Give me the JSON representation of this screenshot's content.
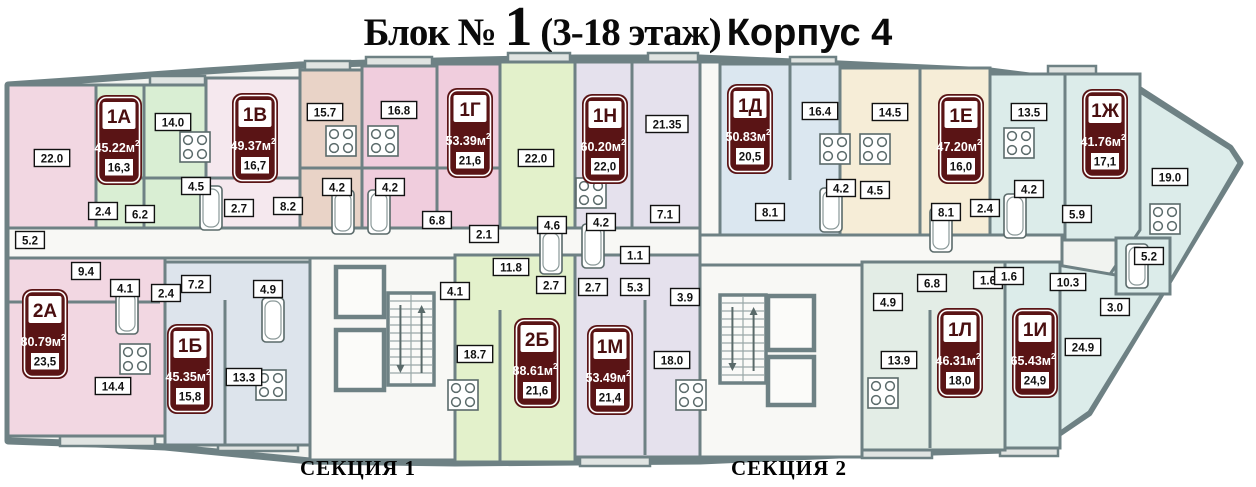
{
  "title": {
    "block": "Блок № ",
    "floor_number": "1",
    "floors": " (3-18 этаж)",
    "building": "Корпус 4"
  },
  "section_labels": [
    {
      "text": "СЕКЦИЯ 1",
      "x": 300,
      "y": 456
    },
    {
      "text": "СЕКЦИЯ 2",
      "x": 731,
      "y": 456
    }
  ],
  "palette": {
    "wall": "#6e8184",
    "outlinefill": "#f1f3f0",
    "badge": "#5a1415",
    "badgetext": "#4a0f10",
    "pink": "#f2d7e2",
    "palepink": "#f5e8ee",
    "tan": "#e9d3c7",
    "rose": "#f0cddd",
    "mint": "#d9eed3",
    "green": "#e3f1cb",
    "lavender": "#e5e1ed",
    "blue": "#dbe7f0",
    "cream": "#f6edd7",
    "cyan": "#dcecea",
    "palegreen": "#e3ede6",
    "bluegray": "#dde4ec",
    "white": "#f8f8f5",
    "balcony": "#e0e4e2"
  },
  "outline": "8,85 96,79 206,71 300,65 437,61 575,58 700,58 840,64 990,71 1140,90 1230,148 1240,163 1089,413 1058,434 1005,450 862,454 700,461 455,463 310,461 165,447 96,444 8,441",
  "apartments": [
    {
      "number": "1А",
      "total": "45.22",
      "unit": "м",
      "sup": "2",
      "living": "16,3",
      "x": 96,
      "y": 95
    },
    {
      "number": "1В",
      "total": "49.37",
      "unit": "м",
      "sup": "2",
      "living": "16,7",
      "x": 232,
      "y": 93
    },
    {
      "number": "1Г",
      "total": "53.39",
      "unit": "м",
      "sup": "2",
      "living": "21,6",
      "x": 447,
      "y": 88
    },
    {
      "number": "1Н",
      "total": "60.20",
      "unit": "м",
      "sup": "2",
      "living": "22,0",
      "x": 582,
      "y": 94
    },
    {
      "number": "1Д",
      "total": "50.83",
      "unit": "м",
      "sup": "2",
      "living": "20,5",
      "x": 727,
      "y": 84
    },
    {
      "number": "1Е",
      "total": "47.20",
      "unit": "м",
      "sup": "2",
      "living": "16,0",
      "x": 938,
      "y": 94
    },
    {
      "number": "1Ж",
      "total": "41.76",
      "unit": "м",
      "sup": "2",
      "living": "17,1",
      "x": 1082,
      "y": 89
    },
    {
      "number": "2А",
      "total": "80.79",
      "unit": "м",
      "sup": "2",
      "living": "23,5",
      "x": 22,
      "y": 289
    },
    {
      "number": "1Б",
      "total": "45.35",
      "unit": "м",
      "sup": "2",
      "living": "15,8",
      "x": 167,
      "y": 324
    },
    {
      "number": "2Б",
      "total": "88.61",
      "unit": "м",
      "sup": "2",
      "living": "21,6",
      "x": 514,
      "y": 318
    },
    {
      "number": "1М",
      "total": "53.49",
      "unit": "м",
      "sup": "2",
      "living": "21,4",
      "x": 587,
      "y": 325
    },
    {
      "number": "1Л",
      "total": "46.31",
      "unit": "м",
      "sup": "2",
      "living": "18,0",
      "x": 937,
      "y": 308
    },
    {
      "number": "1И",
      "total": "65.43",
      "unit": "м",
      "sup": "2",
      "living": "24,9",
      "x": 1012,
      "y": 308
    }
  ],
  "rooms": [
    {
      "x": 8,
      "y": 85,
      "w": 88,
      "h": 143,
      "f": "pink"
    },
    {
      "x": 96,
      "y": 85,
      "w": 110,
      "h": 143,
      "f": "mint"
    },
    {
      "x": 206,
      "y": 78,
      "w": 94,
      "h": 150,
      "f": "palepink"
    },
    {
      "x": 300,
      "y": 70,
      "w": 62,
      "h": 158,
      "f": "tan"
    },
    {
      "x": 362,
      "y": 66,
      "w": 75,
      "h": 162,
      "f": "rose"
    },
    {
      "x": 437,
      "y": 64,
      "w": 63,
      "h": 164,
      "f": "rose"
    },
    {
      "x": 500,
      "y": 62,
      "w": 75,
      "h": 166,
      "f": "green"
    },
    {
      "x": 575,
      "y": 62,
      "w": 125,
      "h": 166,
      "f": "lavender"
    },
    {
      "x": 700,
      "y": 62,
      "w": 20,
      "h": 173,
      "f": "white"
    },
    {
      "x": 720,
      "y": 64,
      "w": 120,
      "h": 171,
      "f": "blue"
    },
    {
      "x": 840,
      "y": 68,
      "w": 150,
      "h": 167,
      "f": "cream"
    },
    {
      "x": 990,
      "y": 74,
      "w": 150,
      "h": 166,
      "f": "cyan"
    },
    {
      "poly": [
        [
          1140,
          92
        ],
        [
          1230,
          149
        ],
        [
          1239,
          163
        ],
        [
          1152,
          312
        ],
        [
          1098,
          292
        ],
        [
          1140,
          230
        ]
      ],
      "f": "cyan"
    },
    {
      "poly": [
        [
          1040,
          262
        ],
        [
          1168,
          284
        ],
        [
          1089,
          412
        ],
        [
          1042,
          445
        ]
      ],
      "f": "cyan"
    },
    {
      "x": 1116,
      "y": 238,
      "w": 54,
      "h": 56,
      "f": "cyan"
    },
    {
      "x": 8,
      "y": 228,
      "w": 692,
      "h": 30,
      "f": "white"
    },
    {
      "x": 700,
      "y": 235,
      "w": 362,
      "h": 30,
      "f": "white"
    },
    {
      "x": 8,
      "y": 258,
      "w": 157,
      "h": 178,
      "f": "pink"
    },
    {
      "x": 165,
      "y": 262,
      "w": 145,
      "h": 183,
      "f": "bluegray"
    },
    {
      "x": 310,
      "y": 258,
      "w": 145,
      "h": 202,
      "f": "white"
    },
    {
      "x": 455,
      "y": 255,
      "w": 120,
      "h": 207,
      "f": "green"
    },
    {
      "x": 575,
      "y": 255,
      "w": 125,
      "h": 202,
      "f": "lavender"
    },
    {
      "x": 700,
      "y": 265,
      "w": 162,
      "h": 192,
      "f": "white"
    },
    {
      "x": 862,
      "y": 262,
      "w": 143,
      "h": 188,
      "f": "palegreen"
    },
    {
      "x": 1005,
      "y": 262,
      "w": 55,
      "h": 186,
      "f": "cyan"
    }
  ],
  "walls": [
    [
      144,
      85,
      144,
      228
    ],
    [
      96,
      178,
      300,
      178
    ],
    [
      300,
      168,
      500,
      168
    ],
    [
      632,
      62,
      632,
      228
    ],
    [
      790,
      64,
      790,
      180
    ],
    [
      920,
      68,
      920,
      235
    ],
    [
      1065,
      74,
      1065,
      240
    ],
    [
      225,
      300,
      225,
      445
    ],
    [
      500,
      310,
      500,
      462
    ],
    [
      645,
      300,
      645,
      455
    ],
    [
      930,
      310,
      930,
      448
    ],
    [
      8,
      302,
      160,
      302
    ]
  ],
  "room_labels": [
    {
      "t": "22.0",
      "x": 52,
      "y": 158
    },
    {
      "t": "14.0",
      "x": 173,
      "y": 122
    },
    {
      "t": "4.5",
      "x": 196,
      "y": 186
    },
    {
      "t": "2.4",
      "x": 103,
      "y": 211
    },
    {
      "t": "6.2",
      "x": 140,
      "y": 214
    },
    {
      "t": "5.2",
      "x": 30,
      "y": 240
    },
    {
      "t": "9.4",
      "x": 86,
      "y": 271
    },
    {
      "t": "4.1",
      "x": 125,
      "y": 288
    },
    {
      "t": "14.4",
      "x": 113,
      "y": 386
    },
    {
      "t": "2.4",
      "x": 166,
      "y": 293
    },
    {
      "t": "7.2",
      "x": 196,
      "y": 284
    },
    {
      "t": "4.9",
      "x": 268,
      "y": 289
    },
    {
      "t": "13.3",
      "x": 244,
      "y": 377
    },
    {
      "t": "2.7",
      "x": 239,
      "y": 208
    },
    {
      "t": "8.2",
      "x": 288,
      "y": 206
    },
    {
      "t": "15.7",
      "x": 325,
      "y": 112
    },
    {
      "t": "4.2",
      "x": 337,
      "y": 187
    },
    {
      "t": "16.8",
      "x": 399,
      "y": 110
    },
    {
      "t": "4.2",
      "x": 390,
      "y": 187
    },
    {
      "t": "6.8",
      "x": 437,
      "y": 220
    },
    {
      "t": "2.1",
      "x": 484,
      "y": 234
    },
    {
      "t": "22.0",
      "x": 536,
      "y": 158
    },
    {
      "t": "4.6",
      "x": 552,
      "y": 225
    },
    {
      "t": "11.8",
      "x": 511,
      "y": 267
    },
    {
      "t": "2.7",
      "x": 551,
      "y": 285
    },
    {
      "t": "18.7",
      "x": 475,
      "y": 354
    },
    {
      "t": "4.1",
      "x": 455,
      "y": 291
    },
    {
      "t": "21.35",
      "x": 667,
      "y": 124
    },
    {
      "t": "4.2",
      "x": 601,
      "y": 222
    },
    {
      "t": "7.1",
      "x": 665,
      "y": 214
    },
    {
      "t": "1.1",
      "x": 635,
      "y": 255
    },
    {
      "t": "2.7",
      "x": 593,
      "y": 287
    },
    {
      "t": "5.3",
      "x": 635,
      "y": 287
    },
    {
      "t": "3.9",
      "x": 685,
      "y": 297
    },
    {
      "t": "18.0",
      "x": 672,
      "y": 360
    },
    {
      "t": "16.4",
      "x": 820,
      "y": 111
    },
    {
      "t": "8.1",
      "x": 770,
      "y": 212
    },
    {
      "t": "4.2",
      "x": 841,
      "y": 188
    },
    {
      "t": "4.5",
      "x": 875,
      "y": 190
    },
    {
      "t": "14.5",
      "x": 890,
      "y": 112
    },
    {
      "t": "8.1",
      "x": 946,
      "y": 212
    },
    {
      "t": "2.4",
      "x": 985,
      "y": 208
    },
    {
      "t": "13.5",
      "x": 1029,
      "y": 112
    },
    {
      "t": "4.2",
      "x": 1029,
      "y": 189
    },
    {
      "t": "5.9",
      "x": 1077,
      "y": 214
    },
    {
      "t": "19.0",
      "x": 1170,
      "y": 177
    },
    {
      "t": "5.2",
      "x": 1149,
      "y": 256
    },
    {
      "t": "10.3",
      "x": 1068,
      "y": 282
    },
    {
      "t": "3.0",
      "x": 1115,
      "y": 307
    },
    {
      "t": "24.9",
      "x": 1083,
      "y": 347
    },
    {
      "t": "6.8",
      "x": 932,
      "y": 283
    },
    {
      "t": "4.9",
      "x": 888,
      "y": 302
    },
    {
      "t": "13.9",
      "x": 899,
      "y": 360
    },
    {
      "t": "1.6",
      "x": 988,
      "y": 280
    },
    {
      "t": "1.6",
      "x": 1009,
      "y": 276
    }
  ],
  "stairs": [
    {
      "x": 388,
      "y": 293,
      "w": 46,
      "h": 92
    },
    {
      "x": 720,
      "y": 295,
      "w": 46,
      "h": 88
    }
  ],
  "elevators": [
    [
      336,
      267,
      48,
      50
    ],
    [
      336,
      330,
      48,
      60
    ],
    [
      768,
      296,
      46,
      54
    ],
    [
      768,
      357,
      46,
      48
    ]
  ],
  "fixtures": {
    "stoves": [
      [
        180,
        132
      ],
      [
        120,
        344
      ],
      [
        256,
        370
      ],
      [
        326,
        126
      ],
      [
        368,
        126
      ],
      [
        576,
        178
      ],
      [
        448,
        380
      ],
      [
        676,
        380
      ],
      [
        820,
        134
      ],
      [
        860,
        134
      ],
      [
        1004,
        128
      ],
      [
        868,
        378
      ],
      [
        1150,
        204
      ]
    ],
    "baths": [
      [
        200,
        186
      ],
      [
        116,
        290
      ],
      [
        262,
        298
      ],
      [
        332,
        190
      ],
      [
        368,
        190
      ],
      [
        540,
        230
      ],
      [
        582,
        224
      ],
      [
        820,
        188
      ],
      [
        930,
        208
      ],
      [
        1004,
        194
      ],
      [
        1126,
        244
      ]
    ]
  },
  "balconies": [
    [
      150,
      76,
      55
    ],
    [
      305,
      61,
      45
    ],
    [
      366,
      57,
      66
    ],
    [
      508,
      53,
      62
    ],
    [
      648,
      53,
      50
    ],
    [
      790,
      57,
      46
    ],
    [
      1048,
      66,
      48
    ],
    [
      60,
      436,
      95
    ],
    [
      218,
      441,
      80
    ],
    [
      580,
      456,
      70
    ],
    [
      862,
      448,
      70
    ],
    [
      1000,
      446,
      58
    ]
  ]
}
